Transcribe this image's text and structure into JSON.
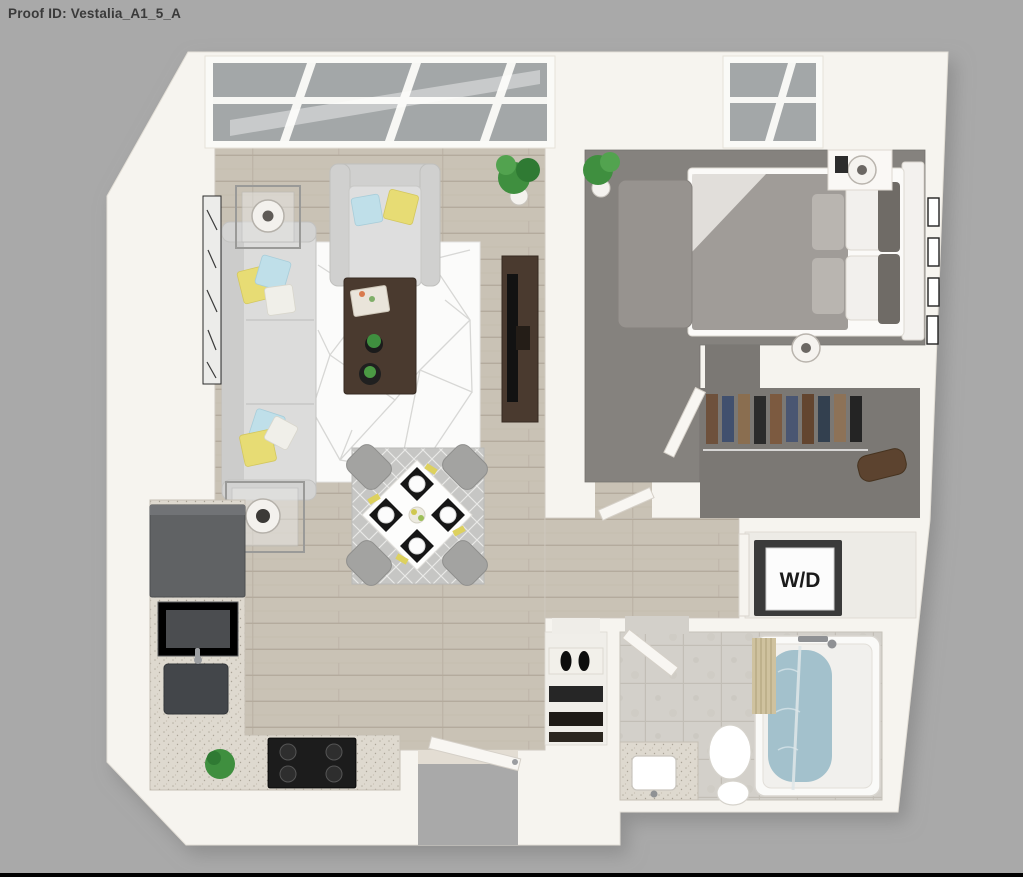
{
  "header": {
    "proof_id_label": "Proof ID: Vestalia_A1_5_A"
  },
  "floor_plan": {
    "wd_label": "W/D",
    "colors": {
      "background": "#a9a9a9",
      "title_text": "#3a3a3a",
      "wall": "#f6f4ef",
      "wall_edge": "#d9d4cc",
      "wood_floor": "#c9c2b5",
      "plank_line": "#b4ab9d",
      "carpet": "#85827e",
      "closet_carpet": "#7b7874",
      "tile_floor": "#d3d0ca",
      "glass": "#a3a7a8",
      "living_rug": "#fbfbfa",
      "dining_rug": "#c6c6c4",
      "sofa": "#dcdcdb",
      "pillow_yellow": "#e7dc74",
      "pillow_blue": "#bfdfe9",
      "dark_wood": "#4a3a2f",
      "tv_black": "#121212",
      "appliance_gray": "#606264",
      "stove_black": "#1c1c1c",
      "granite": "#ded9cf",
      "water_blue": "#a3c1cc",
      "curtain_tan": "#cfc29f",
      "plant_green": "#3f8f3f",
      "wd_box_side": "#3a3a3a",
      "wd_box_face": "#fcfcfc",
      "bottom_border": "#000000"
    }
  }
}
